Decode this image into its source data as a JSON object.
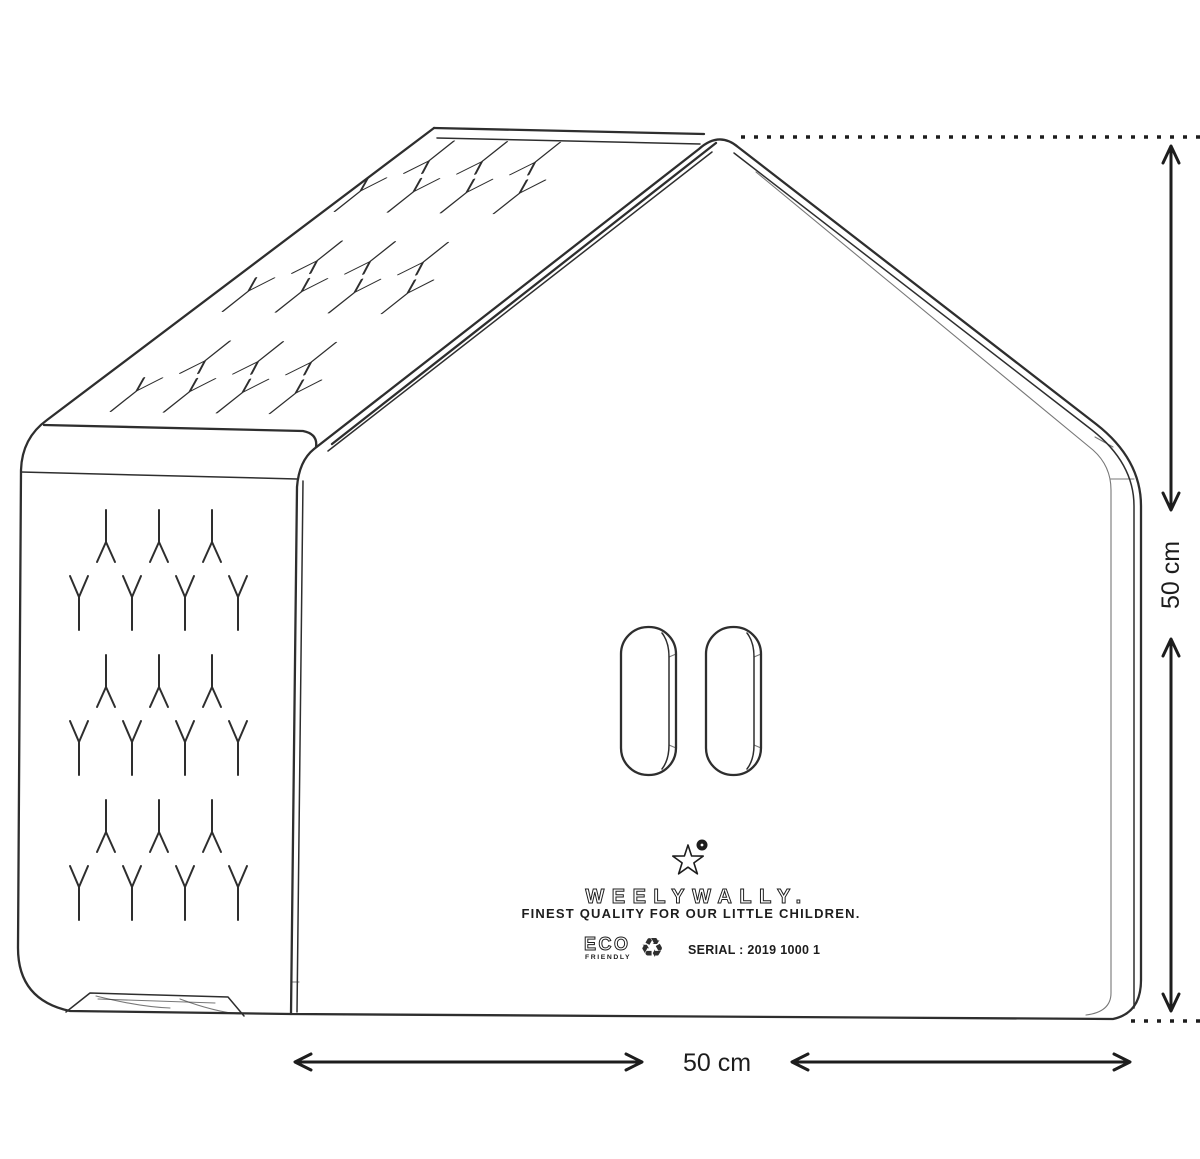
{
  "brand": {
    "wordmark": "WEELYWALLY.",
    "tagline": "FINEST QUALITY FOR OUR LITTLE CHILDREN.",
    "eco_line1": "ECO",
    "eco_line2": "FRIENDLY",
    "serial": "SERIAL : 2019 1000 1",
    "recycle_glyph": "♻",
    "star_icon": "star-icon",
    "registered_dot_icon": "registered-mark-icon"
  },
  "dimensions": {
    "width_label": "50 cm",
    "height_label": "50 cm"
  },
  "colors": {
    "line": "#2e2e2e",
    "ink": "#1d1d1d",
    "bg": "#ffffff"
  },
  "pattern": {
    "wall": {
      "group_origins_y": [
        510,
        655,
        800
      ],
      "lambda_xs": [
        106,
        159,
        212
      ],
      "lambda_dy": 28,
      "y_xs": [
        79,
        132,
        185,
        238
      ],
      "y_dy": 92
    },
    "roof": {
      "matrix": [
        1,
        0.014,
        -0.78,
        0.62
      ],
      "band_origins": [
        [
          402,
          158
        ],
        [
          290,
          258
        ],
        [
          178,
          358
        ]
      ],
      "lambda_xs": [
        30,
        83,
        136
      ],
      "lambda_dy": 0,
      "y_xs": [
        0,
        53,
        106,
        159
      ],
      "y_dy": 58
    }
  }
}
